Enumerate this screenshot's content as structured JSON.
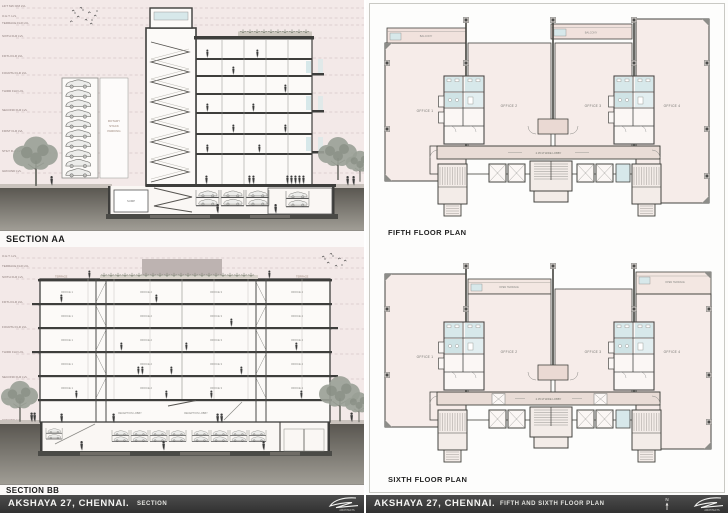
{
  "colors": {
    "sheet_pink": "#f3e9e8",
    "plan_fill": "#f6ece9",
    "balcony_fill": "#f1e2dd",
    "core_blue": "#d7e8ea",
    "wall_dark": "#3f3f3c",
    "lobby_fill": "#e9dcd6",
    "ground_dark": "#57544e",
    "titlebar_dark": "#3d3d3d",
    "tree_gray": "#9aa096"
  },
  "sheet_left": {
    "section_aa": {
      "title": "SECTION AA",
      "levels": [
        "LIFT M/C RM LVL",
        "O.H.T. LVL",
        "TERRACE FLR LVL",
        "SIXTH FLR LVL",
        "FIFTH FLR LVL",
        "FOURTH FLR LVL",
        "THIRD FLR LVL",
        "SECOND FLR LVL",
        "FIRST FLR LVL",
        "STILT FLR LVL",
        "GROUND LVL"
      ],
      "parking_label_lines": [
        "ROTARY",
        "STACK",
        "PARKING"
      ],
      "sump_label": "SUMP"
    },
    "section_bb": {
      "title": "SECTION BB",
      "levels": [
        "O.H.T. LVL",
        "TERRACE FLR LVL",
        "SIXTH FLR LVL",
        "FIFTH FLR LVL",
        "FOURTH FLR LVL",
        "THIRD FLR LVL",
        "SECOND FLR LVL",
        "FIRST FLR LVL",
        "GROUND LVL"
      ],
      "terrace_label": "TERRACE",
      "office_labels": [
        "OFFICE 1",
        "OFFICE 2",
        "OFFICE 3",
        "OFFICE 4"
      ],
      "reception_label": "RECEPTION LOBBY"
    },
    "titlebar": {
      "project": "AKSHAYA 27, CHENNAI.",
      "sheet_name": "SECTION"
    }
  },
  "sheet_right": {
    "fifth_floor_plan": {
      "title": "FIFTH FLOOR PLAN",
      "offices": [
        "OFFICE 1",
        "OFFICE 2",
        "OFFICE 3",
        "OFFICE 4"
      ],
      "balcony_label": "BALCONY",
      "lobby_label": "2.35 M WIDE LOBBY"
    },
    "sixth_floor_plan": {
      "title": "SIXTH FLOOR PLAN",
      "offices": [
        "OFFICE 1",
        "OFFICE 2",
        "OFFICE 3",
        "OFFICE 4"
      ],
      "terrace_label": "OPEN TERRACE",
      "lobby_label": "2.35 M WIDE LOBBY"
    },
    "titlebar": {
      "project": "AKSHAYA 27, CHENNAI.",
      "sheet_name": "FIFTH AND SIXTH FLOOR PLAN",
      "north_label": "N"
    }
  },
  "branding": {
    "logo_text": "ARCHITECTS"
  }
}
